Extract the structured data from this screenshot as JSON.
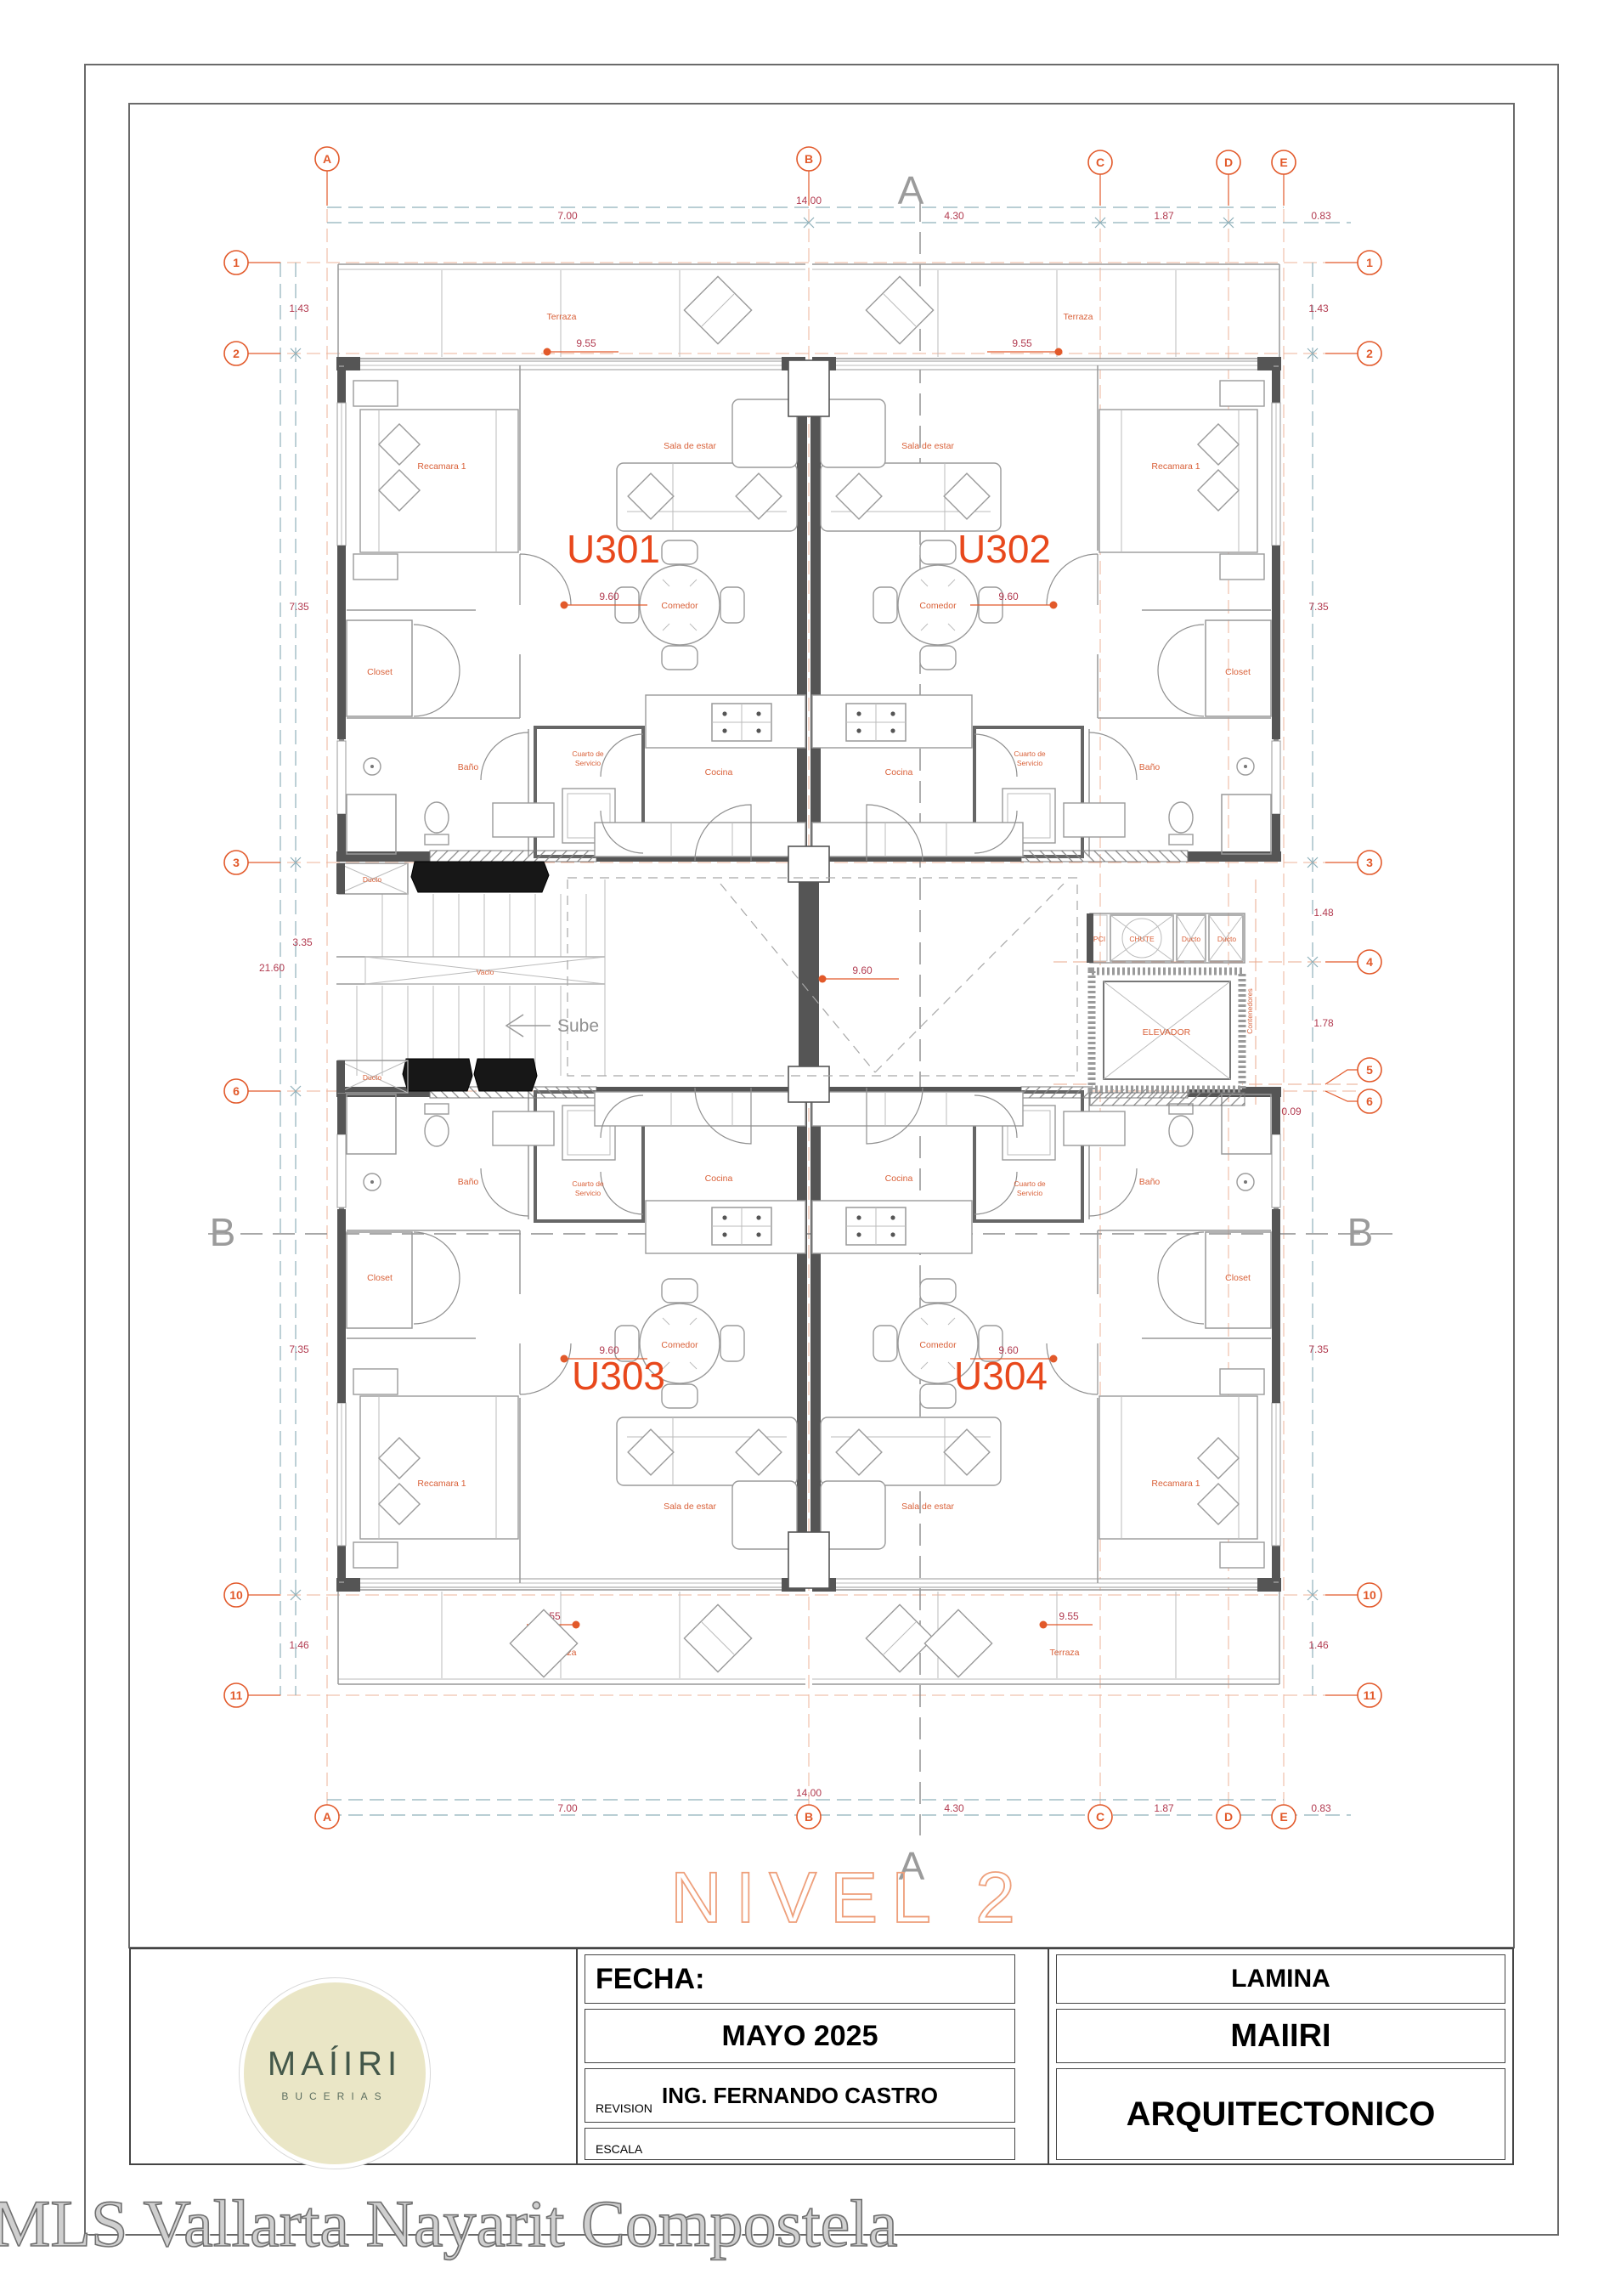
{
  "sheet": {
    "level_title": "NIVEL 2",
    "watermark": "MLS Vallarta Nayarit Compostela"
  },
  "logo": {
    "name": "MAÍIRI",
    "sub": "BUCERIAS"
  },
  "titleblock": {
    "fecha_label": "FECHA:",
    "fecha_value": "MAYO 2025",
    "revision_label": "REVISION",
    "revision_value": "ING. FERNANDO CASTRO",
    "escala_label": "ESCALA",
    "lamina_label": "LAMINA",
    "lamina_value": "MAIIRI",
    "tipo_value": "ARQUITECTONICO"
  },
  "grid": {
    "cols": [
      "A",
      "B",
      "C",
      "D",
      "E"
    ],
    "rows_left": [
      "1",
      "2",
      "3",
      "6",
      "10",
      "11"
    ],
    "rows_right": [
      "1",
      "2",
      "3",
      "4",
      "5",
      "6",
      "10",
      "11"
    ]
  },
  "dims": {
    "top_total": "14.00",
    "top": [
      "7.00",
      "4.30",
      "1.87",
      "0.83"
    ],
    "bottom_total": "14.00",
    "bottom": [
      "7.00",
      "4.30",
      "1.87",
      "0.83"
    ],
    "left": [
      "1.43",
      "7.35",
      "3.35",
      "21.60",
      "7.35",
      "1.46"
    ],
    "right": [
      "1.43",
      "7.35",
      "1.48",
      "1.78",
      "0.09",
      "7.35",
      "1.46"
    ]
  },
  "sections": {
    "a": "A",
    "b": "B"
  },
  "units": [
    {
      "id": "U301",
      "recamara": "Recamara 1",
      "closet": "Closet",
      "bano": "Baño",
      "cuarto_1": "Cuarto de",
      "cuarto_2": "Servicio",
      "cocina": "Cocina",
      "comedor": "Comedor",
      "sala": "Sala de estar",
      "dim": "9.60"
    },
    {
      "id": "U302",
      "recamara": "Recamara 1",
      "closet": "Closet",
      "bano": "Baño",
      "cuarto_1": "Cuarto de",
      "cuarto_2": "Servicio",
      "cocina": "Cocina",
      "comedor": "Comedor",
      "sala": "Sala de estar",
      "dim": "9.60"
    },
    {
      "id": "U303",
      "recamara": "Recamara 1",
      "closet": "Closet",
      "bano": "Baño",
      "cuarto_1": "Cuarto de",
      "cuarto_2": "Servicio",
      "cocina": "Cocina",
      "comedor": "Comedor",
      "sala": "Sala de estar",
      "dim": "9.60"
    },
    {
      "id": "U304",
      "recamara": "Recamara 1",
      "closet": "Closet",
      "bano": "Baño",
      "cuarto_1": "Cuarto de",
      "cuarto_2": "Servicio",
      "cocina": "Cocina",
      "comedor": "Comedor",
      "sala": "Sala de estar",
      "dim": "9.60"
    }
  ],
  "terraces": [
    {
      "label": "Terraza",
      "dim": "9.55"
    },
    {
      "label": "Terraza",
      "dim": "9.55"
    },
    {
      "label": "Terraza",
      "dim": "9.55"
    },
    {
      "label": "Terraza",
      "dim": "9.55"
    }
  ],
  "core": {
    "ducto_left_1": "Ducto",
    "ducto_left_2": "Ducto",
    "vacio": "Vacio",
    "sube": "Sube",
    "pci": "PCI",
    "chute": "CHUTE",
    "ducto_right_1": "Ducto",
    "ducto_right_2": "Ducto",
    "elevador": "ELEVADOR",
    "contenedores": "Contenedores",
    "dim": "9.60"
  }
}
